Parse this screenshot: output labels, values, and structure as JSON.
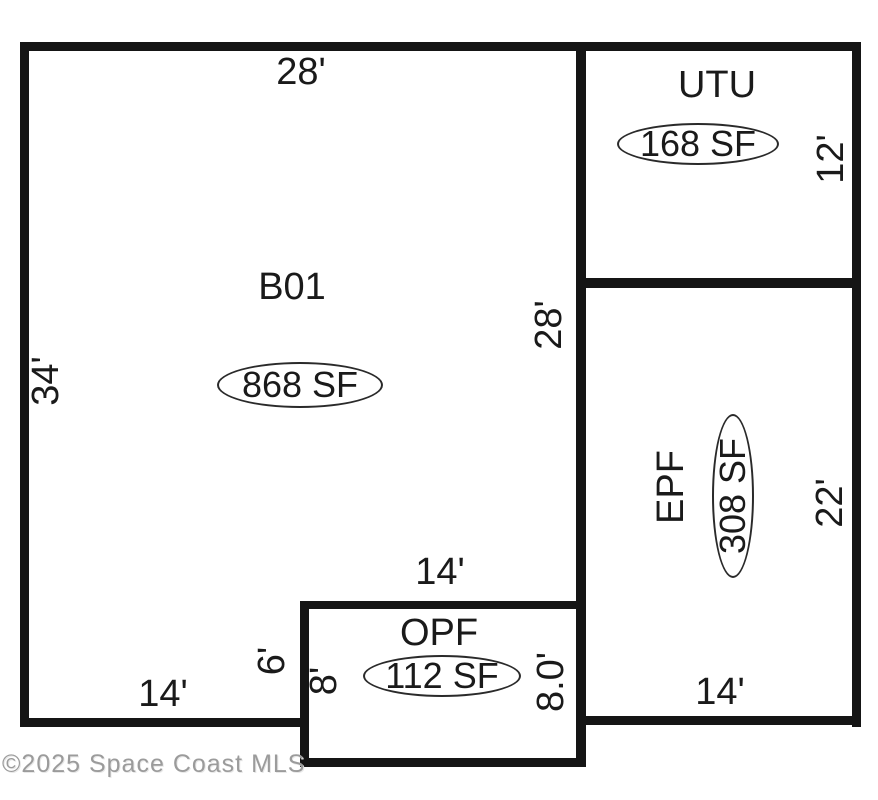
{
  "plan": {
    "watermark": "©2025 Space Coast MLS",
    "colors": {
      "background": "#ffffff",
      "wall": "#151515",
      "text": "#1a1a1a",
      "watermark": "#9b9b9b"
    },
    "rooms": {
      "b01": {
        "name": "B01",
        "area": "868 SF",
        "dims": {
          "top": "28'",
          "left": "34'",
          "right": "28'",
          "bottom": "14'"
        }
      },
      "utu": {
        "name": "UTU",
        "area": "168 SF",
        "dims": {
          "right": "12'"
        }
      },
      "epf": {
        "name": "EPF",
        "area": "308 SF",
        "dims": {
          "right": "22'",
          "bottom": "14'"
        }
      },
      "opf": {
        "name": "OPF",
        "area": "112 SF",
        "dims": {
          "top": "14'",
          "outer_left": "6'",
          "left": "8'",
          "right": "8.0'"
        }
      }
    }
  }
}
